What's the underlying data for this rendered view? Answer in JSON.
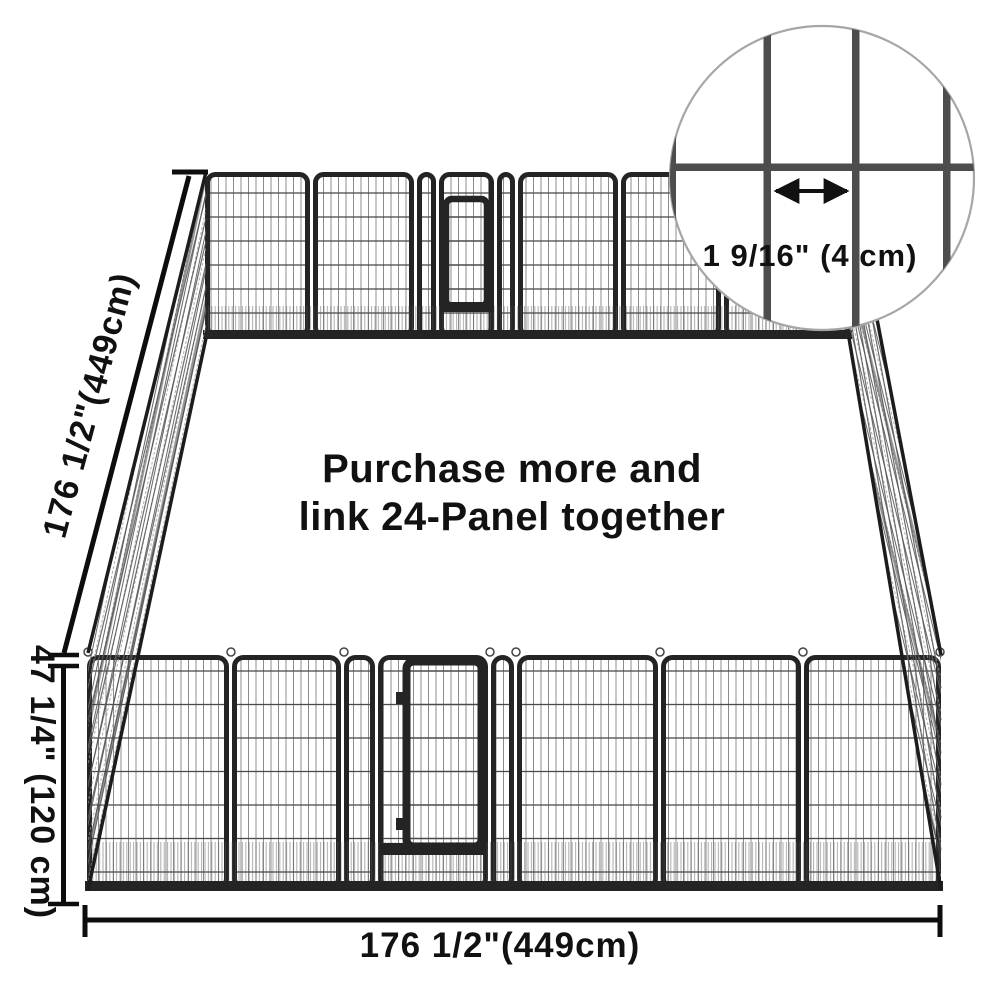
{
  "page": {
    "background": "#ffffff",
    "description": "Dimension diagram of a 24-panel heavy-duty metal dog playpen with mesh detail inset"
  },
  "dimensions": {
    "depth_label": "176 1/2\"(449cm)",
    "height_label": "47 1/4\" (120 cm)",
    "width_label": "176 1/2\"(449cm)"
  },
  "inset": {
    "spacing_label": "1 9/16\" (4 cm)"
  },
  "promo": {
    "line1": "Purchase more and",
    "line2": "link 24-Panel together"
  },
  "colors": {
    "promo_orange": "#f0663c",
    "dimension_line": "#0d0d0d",
    "frame_dark": "#242424",
    "inset_bar": "#4d4d4d",
    "inset_circle_stroke": "#a6a6a6"
  }
}
